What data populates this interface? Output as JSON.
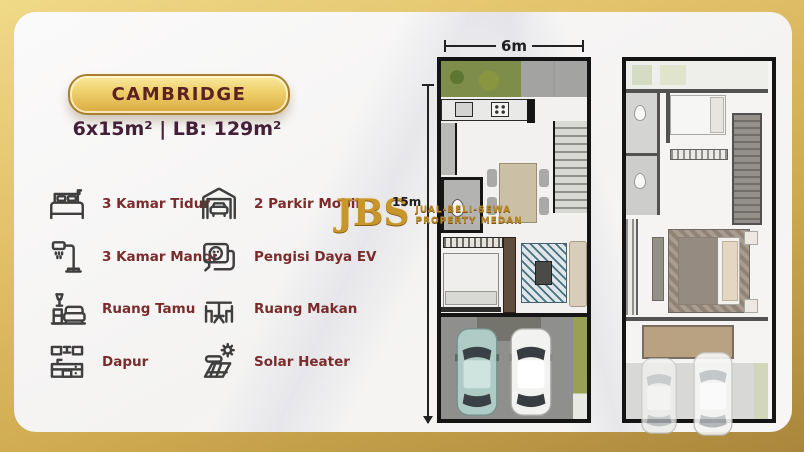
{
  "badge": {
    "title": "CAMBRIDGE"
  },
  "specs": {
    "text": "6x15m² | LB: 129m²"
  },
  "features": {
    "left": [
      {
        "icon": "bed-icon",
        "label": "3 Kamar Tidur"
      },
      {
        "icon": "shower-icon",
        "label": "3 Kamar Mandi"
      },
      {
        "icon": "sofa-icon",
        "label": "Ruang Tamu"
      },
      {
        "icon": "kitchen-icon",
        "label": "Dapur"
      }
    ],
    "right": [
      {
        "icon": "garage-icon",
        "label": "2 Parkir Mobil"
      },
      {
        "icon": "ev-charger-icon",
        "label": "Pengisi Daya EV"
      },
      {
        "icon": "dining-table-icon",
        "label": "Ruang Makan"
      },
      {
        "icon": "solar-heater-icon",
        "label": "Solar Heater"
      }
    ]
  },
  "logo": {
    "initials": "JBS",
    "line1": "JUAL-BELI-SEWA",
    "line2": "PROPERTY MEDAN"
  },
  "dimensions": {
    "width_label": "6m",
    "height_label": "15m"
  },
  "colors": {
    "gold_frame": "#cfa94f",
    "badge_text": "#5c2222",
    "feature_text": "#7a2b2b",
    "specs_text": "#442038",
    "plan_border": "#141414"
  }
}
